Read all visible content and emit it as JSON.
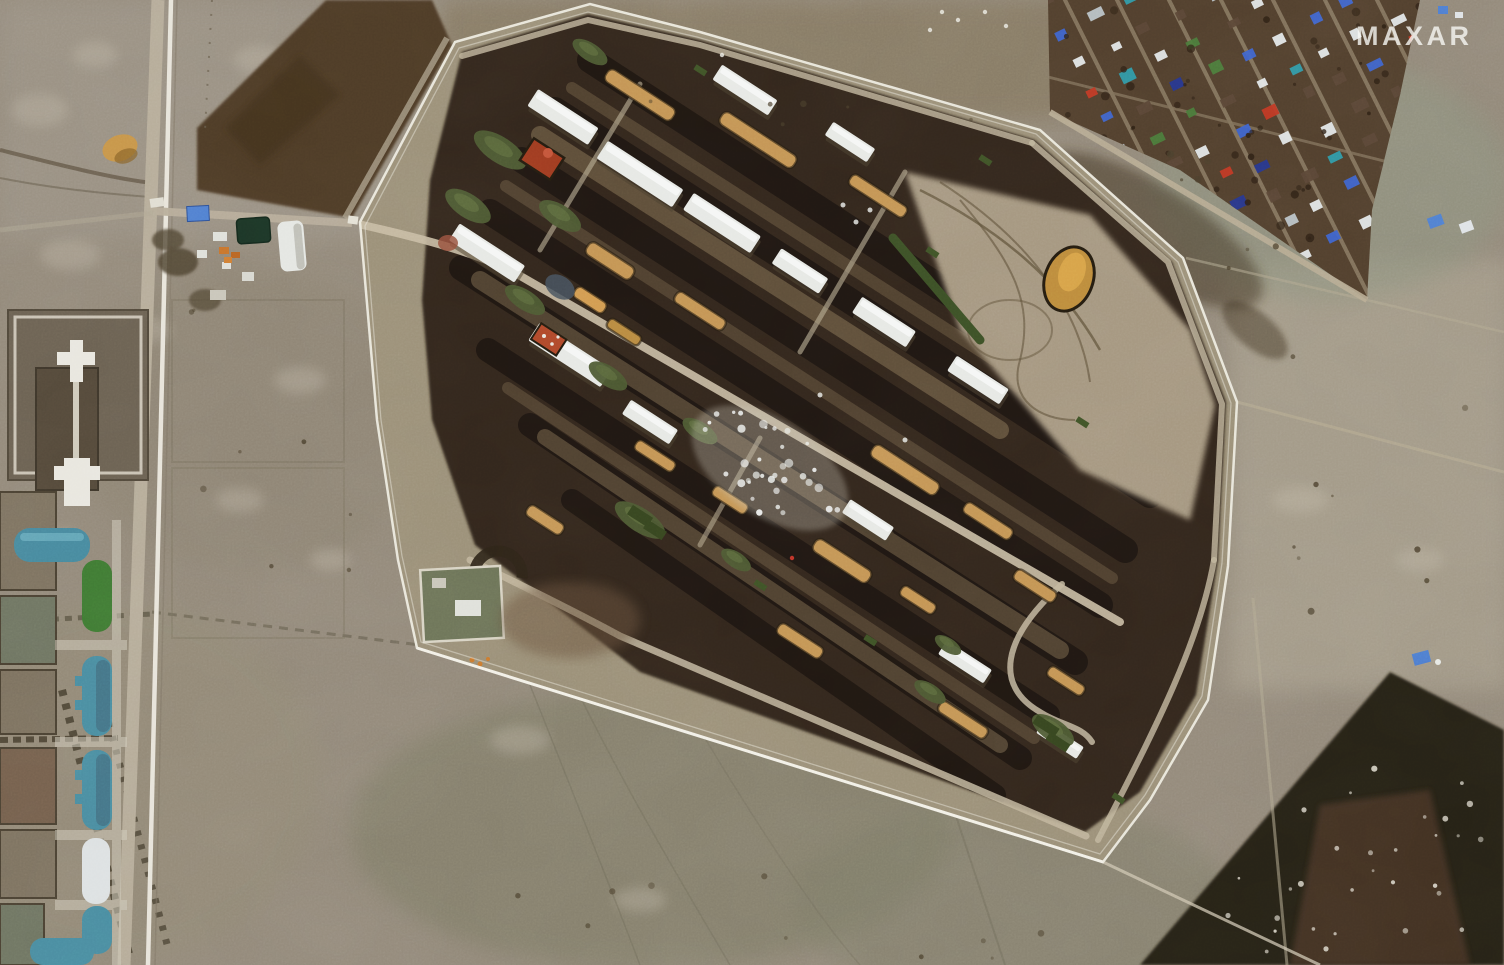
{
  "watermark": {
    "text": "MAXAR",
    "color": "rgba(248,248,244,0.8)"
  },
  "palette": {
    "field_base": "#93897a",
    "field_light": "#a89e8d",
    "field_olive": "#7e7c66",
    "field_dark_plowed": "#4e3b26",
    "berm_dark": "#33271a",
    "berm_shadow": "#1b1410",
    "depot_yard": "#a2947c",
    "road_light": "#b6ac99",
    "rail_white": "#e8e4da",
    "fence_white": "#edebdf",
    "building_white": "#e7e9e5",
    "crate_tan": "#c49554",
    "crate_gold": "#bd8c3c",
    "rust_red": "#a03b20",
    "mound_green": "#4d5a33",
    "crate_green": "#3c5026",
    "tank_teal": "#4a8da1",
    "tank_green": "#3f7a33",
    "tank_white": "#dde1e2",
    "pond_green": "#1c3526",
    "checkpoint_blue": "#4f7fd0",
    "vehicle_orange": "#c8742c",
    "village_ground": "#513f2d",
    "woods_dark": "#262014",
    "village_roofs": [
      "#e3e7e8",
      "#5a4636",
      "#3d63cc",
      "#26368e",
      "#c03824",
      "#2f9aa8",
      "#b9c2c6",
      "#4a7a3a"
    ]
  }
}
